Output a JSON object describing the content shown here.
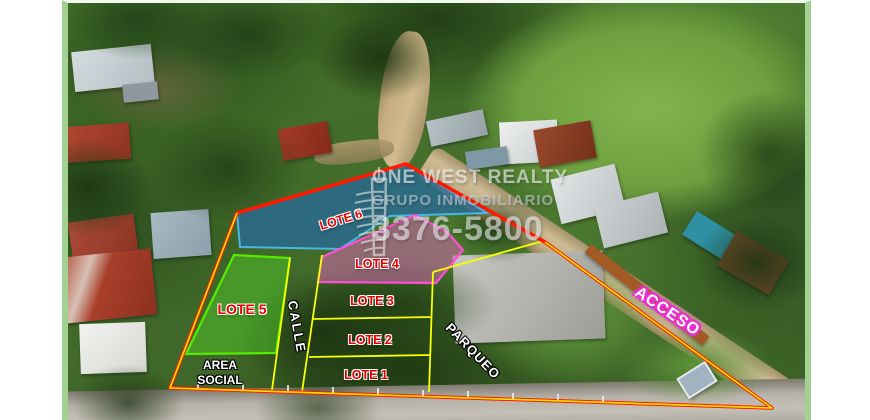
{
  "watermark": {
    "line1": "ONE WEST REALTY",
    "line2": "GRUPO INMOBILIARIO",
    "phone": "3376-5800",
    "logo": "building-tower-icon"
  },
  "labels": {
    "lote1": "LOTE 1",
    "lote2": "LOTE 2",
    "lote3": "LOTE 3",
    "lote4": "LOTE 4",
    "lote5": "LOTE 5",
    "lote6": "LOTE 6",
    "calle": "CALLE",
    "parqueo": "PARQUEO",
    "acceso": "ACCESO",
    "area_social_line1": "AREA",
    "area_social_line2": "SOCIAL"
  },
  "colors": {
    "boundary_red": "#ff1a00",
    "boundary_yellow": "#ffe600",
    "lote6_fill": "rgba(38,106,160,0.72)",
    "lote6_stroke": "#47b6e8",
    "lote5_fill": "rgba(80,200,40,0.50)",
    "lote5_stroke": "#55ec00",
    "lote4_fill": "rgba(210,100,175,0.55)",
    "lote4_stroke": "#ff4fd4",
    "divider_yellow": "#f8ff00",
    "lot_label_red": "#e60000",
    "lot_label_outline": "#ffffff",
    "road_label_white": "#ffffff",
    "acceso_glow": "#f02cd8",
    "frame_border_green": "#a3d191"
  },
  "styles": {
    "property_boundary": "fill:none;stroke:#ff1a00;stroke-width:3.6;stroke-linejoin:round",
    "boundary_inner": "fill:none;stroke:#ffe600;stroke-width:1.6;stroke-linejoin:round",
    "lote6": "fill:rgba(38,106,160,0.72);stroke:#47b6e8;stroke-width:2",
    "lote5": "fill:rgba(80,200,40,0.5);stroke:#55ec00;stroke-width:2.2",
    "lote4": "fill:rgba(210,100,175,0.55);stroke:#ff4fd4;stroke-width:2.2",
    "divider": "fill:none;stroke:#f8ff00;stroke-width:1.8",
    "fence_posts": "stroke:#eeeeee;stroke-width:2;opacity:0.85"
  }
}
